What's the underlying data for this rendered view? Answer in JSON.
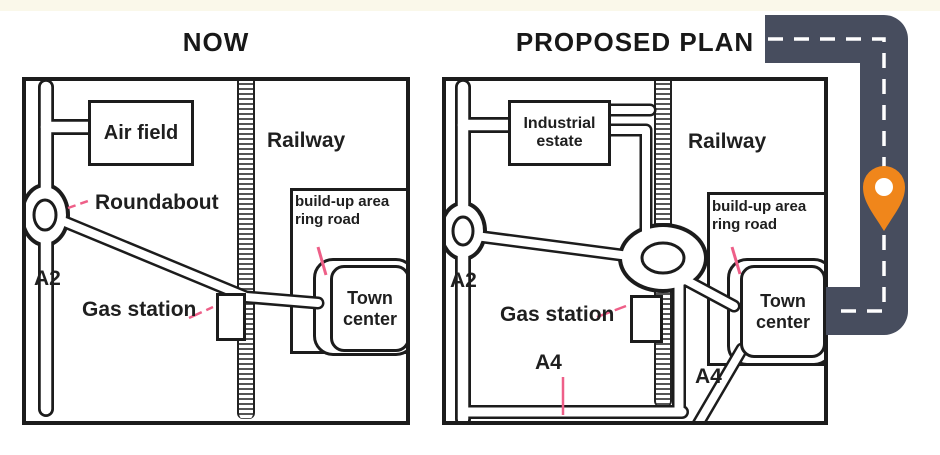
{
  "titles": {
    "now": "NOW",
    "proposed": "PROPOSED PLAN"
  },
  "maps": {
    "now": {
      "labels": {
        "airfield": "Air field",
        "railway": "Railway",
        "roundabout": "Roundabout",
        "a2": "A2",
        "gas_station": "Gas station",
        "buildup_line1": "build-up area",
        "buildup_line2": "ring road",
        "town_line1": "Town",
        "town_line2": "center"
      }
    },
    "proposed": {
      "labels": {
        "industrial_line1": "Industrial",
        "industrial_line2": "estate",
        "railway": "Railway",
        "a2": "A2",
        "gas_station": "Gas station",
        "a4_south": "A4",
        "a4_east": "A4",
        "buildup_line1": "build-up area",
        "buildup_line2": "ring road",
        "town_line1": "Town",
        "town_line2": "center"
      }
    }
  },
  "icons": {
    "pin": "location-pin"
  },
  "colors": {
    "map_line": "#1c1c1c",
    "leader_pink": "#ee5f88",
    "road_dark": "#474d5e",
    "pin_orange": "#f0861b",
    "top_strip_cream": "#faf8ea"
  }
}
